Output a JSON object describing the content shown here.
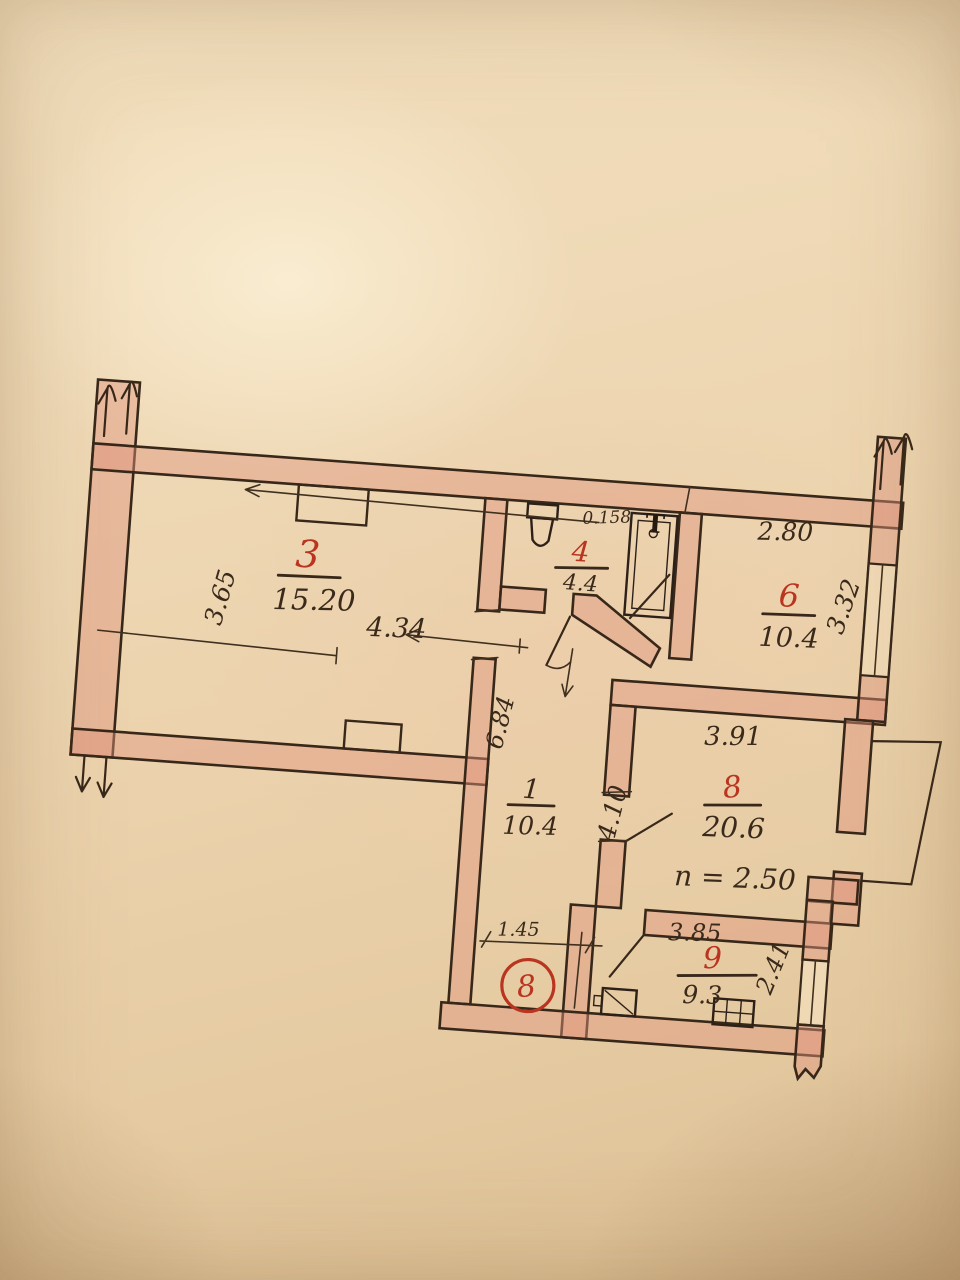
{
  "plan": {
    "colors": {
      "red": "#b9351f",
      "ink": "#3a2a1b",
      "wall_fill": "#e0948a",
      "paper": "#eed8b6"
    },
    "apartment": {
      "number": "8"
    },
    "rooms": [
      {
        "id": "3",
        "number": "3",
        "area": "15.20"
      },
      {
        "id": "4",
        "number": "4",
        "area": "4.4"
      },
      {
        "id": "6",
        "number": "6",
        "area": "10.4"
      },
      {
        "id": "1",
        "number": "1",
        "area": "10.4"
      },
      {
        "id": "8",
        "number": "8",
        "area": "20.6",
        "height_note": "n = 2.50"
      },
      {
        "id": "9",
        "number": "9",
        "area": "9.3"
      }
    ],
    "dimensions": {
      "room3_width": "4.34",
      "room3_depth": "3.65",
      "room6_width": "2.80",
      "room6_depth": "3.32",
      "hall_depth": "6.84",
      "hall_opening": "1.45",
      "room8_width": "3.91",
      "room8_depth": "4.10",
      "room9_width": "3.85",
      "room9_depth": "2.41"
    },
    "annotations": {
      "bath_scribble": "0.158",
      "bath_fixture_mark": "Т"
    }
  }
}
